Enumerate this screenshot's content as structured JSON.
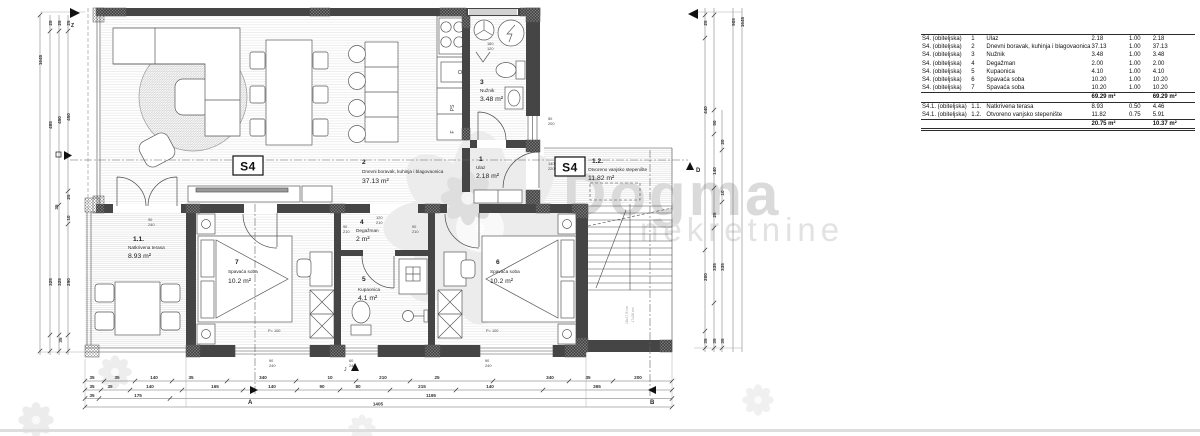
{
  "unit": {
    "label": "S4"
  },
  "rooms": [
    {
      "num": "1",
      "name": "Ulaz",
      "area": "2.18 m²"
    },
    {
      "num": "2",
      "name": "Dnevni boravak, kuhinja i blagovaonica",
      "area": "37.13 m²"
    },
    {
      "num": "3",
      "name": "Nužnik",
      "area": "3.48 m²"
    },
    {
      "num": "4",
      "name": "Degažman",
      "area": "2 m²"
    },
    {
      "num": "5",
      "name": "Kupaonica",
      "area": "4.1 m²"
    },
    {
      "num": "6",
      "name": "Spavaća soba",
      "area": "10.2 m²"
    },
    {
      "num": "7",
      "name": "Spavaća soba",
      "area": "10.2 m²"
    },
    {
      "num": "1.1.",
      "name": "Natkrivena terasa",
      "area": "8.93 m²"
    },
    {
      "num": "1.2.",
      "name": "Otvoreno vanjsko stepenište",
      "area": "11.82 m²"
    }
  ],
  "table": {
    "rows": [
      {
        "unit": "S4. (obiteljska)",
        "no": "1",
        "name": "Ulaz",
        "area": "2.18",
        "coef": "1.00",
        "total": "2.18"
      },
      {
        "unit": "S4. (obiteljska)",
        "no": "2",
        "name": "Dnevni boravak, kuhinja i blagovaonica",
        "area": "37.13",
        "coef": "1.00",
        "total": "37.13"
      },
      {
        "unit": "S4. (obiteljska)",
        "no": "3",
        "name": "Nužnik",
        "area": "3.48",
        "coef": "1.00",
        "total": "3.48"
      },
      {
        "unit": "S4. (obiteljska)",
        "no": "4",
        "name": "Degažman",
        "area": "2.00",
        "coef": "1.00",
        "total": "2.00"
      },
      {
        "unit": "S4. (obiteljska)",
        "no": "5",
        "name": "Kupaonica",
        "area": "4.10",
        "coef": "1.00",
        "total": "4.10"
      },
      {
        "unit": "S4. (obiteljska)",
        "no": "6",
        "name": "Spavaća soba",
        "area": "10.20",
        "coef": "1.00",
        "total": "10.20"
      },
      {
        "unit": "S4. (obiteljska)",
        "no": "7",
        "name": "Spavaća soba",
        "area": "10.20",
        "coef": "1.00",
        "total": "10.20"
      }
    ],
    "sub1": {
      "area": "69.29 m²",
      "total": "69.29 m²"
    },
    "rows2": [
      {
        "unit": "S4.1. (obiteljska)",
        "no": "1.1.",
        "name": "Natkrivena terasa",
        "area": "8.93",
        "coef": "0.50",
        "total": "4.46"
      },
      {
        "unit": "S4.1. (obiteljska)",
        "no": "1.2.",
        "name": "Otvoreno vanjsko stepenište",
        "area": "11.82",
        "coef": "0.75",
        "total": "5.91"
      }
    ],
    "sub2": {
      "area": "20.75 m²",
      "total": "10.37 m²"
    }
  },
  "dims": {
    "b1": [
      "35",
      "35",
      "140",
      "35",
      "340",
      "10",
      "210",
      "25",
      "340",
      "35",
      "200"
    ],
    "b2": [
      "35",
      "35",
      "140",
      "165",
      "140",
      "90",
      "80",
      "215",
      "140",
      "365"
    ],
    "b3": [
      "35",
      "175",
      "1195"
    ],
    "total": "1405",
    "left": [
      "1645",
      "25",
      "25",
      "25",
      "485",
      "450",
      "450",
      "25",
      "35",
      "10",
      "325",
      "325",
      "290",
      "35"
    ],
    "right": [
      "25",
      "440",
      "200",
      "35",
      "50",
      "140",
      "25",
      "335",
      "35",
      "20",
      "10",
      "335",
      "35",
      "905",
      "1645"
    ],
    "stacks": [
      [
        "90",
        "240"
      ],
      [
        "90",
        "240"
      ],
      [
        "60",
        "240"
      ],
      [
        "90",
        "240"
      ],
      [
        "50",
        "200"
      ],
      [
        "140",
        "220"
      ],
      [
        "120",
        "210"
      ],
      [
        "90",
        "210"
      ],
      [
        "90",
        "210"
      ],
      [
        "180",
        "120"
      ]
    ]
  },
  "labels": {
    "p100": "P= 100",
    "ps": "PS",
    "f": "F",
    "stair1": "18x17,8 cm",
    "stair2": "17x28 cm",
    "a": "A",
    "b": "B",
    "d": "D",
    "z": "Z",
    "j": "J"
  },
  "watermark": {
    "line1": "Dogma",
    "line2": "nekretnine"
  }
}
